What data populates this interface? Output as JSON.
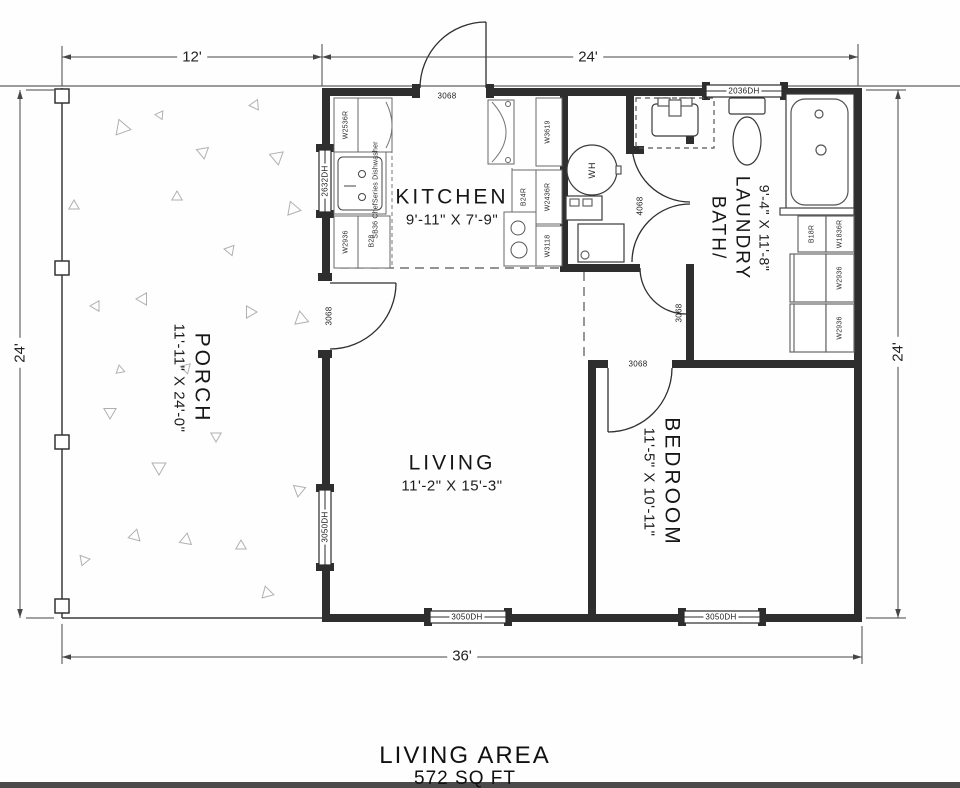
{
  "title": {
    "line1": "LIVING AREA",
    "line2": "572 SQ FT"
  },
  "dims": {
    "top_left": "12'",
    "top_right": "24'",
    "left": "24'",
    "right": "24'",
    "bottom": "36'"
  },
  "rooms": {
    "kitchen": {
      "name": "KITCHEN",
      "size": "9'-11\" X 7'-9\""
    },
    "living": {
      "name": "LIVING",
      "size": "11'-2\" X 15'-3\""
    },
    "porch": {
      "name": "PORCH",
      "size": "11'-11\" X 24'-0\""
    },
    "bedroom": {
      "name": "BEDROOM",
      "size": "11'-5\" X 10'-11\""
    },
    "bath": {
      "name1": "BATH/",
      "name2": "LAUNDRY",
      "size": "9'-4\" X 11'-8\""
    }
  },
  "windows": {
    "kitchen_left": "2632DH",
    "bath_top": "2036DH",
    "living_left": "3050DH",
    "living_bottom": "3050DH",
    "bedroom_bottom": "3050DH"
  },
  "doors": {
    "entry": "3068",
    "porch": "3068",
    "bath": "3068",
    "bedroom": "3068",
    "closet": "4068"
  },
  "cabinets": {
    "kitchen_left": {
      "upper": "W2536R",
      "sink": "SB36 ChefSeries Dishwasher",
      "lower_wall": "W2936",
      "lower_base": "B28"
    },
    "kitchen_right": {
      "top": "W3619",
      "base": "B24R",
      "wall": "W2436R",
      "bottom": "W3118"
    },
    "bath_right": {
      "b18r": "B18R",
      "w1836r": "W1836R",
      "w2936_a": "W2936",
      "w2936_b": "W2936"
    }
  },
  "fixtures": {
    "water_heater": "WH"
  },
  "colors": {
    "ink": "#1b1b1b",
    "wall": "#2e2e2e",
    "roofline": "#9c9c9c",
    "dimension": "#474747",
    "porch_texture": "#b0b0b0"
  }
}
